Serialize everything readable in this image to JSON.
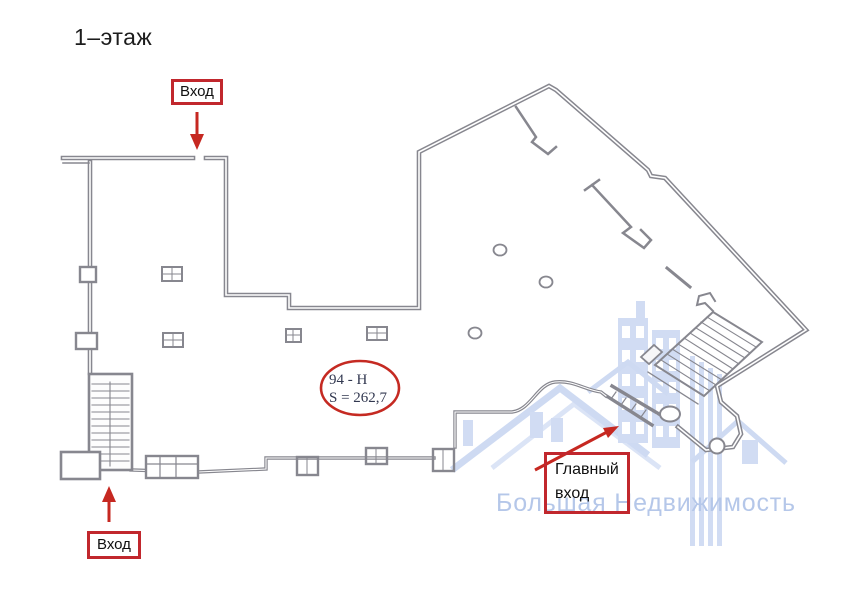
{
  "title": "1–этаж",
  "annotations": {
    "entrance_top": {
      "label": "Вход"
    },
    "entrance_bottom": {
      "label": "Вход"
    },
    "main_entrance": {
      "label": "Главный\nвход"
    }
  },
  "room": {
    "number": "94 - Н",
    "area": "S = 262,7"
  },
  "watermark": {
    "text": "Большая Недвижимость"
  },
  "colors": {
    "annotation_red": "#c1272d",
    "plan_gray": "#87878f",
    "watermark_blue": "#c6d4f0",
    "watermark_text_blue": "#abc0e7"
  },
  "icons": {
    "entrance_top_arrow": "arrow-down-icon",
    "entrance_bottom_arrow": "arrow-up-icon",
    "main_entrance_arrow": "arrow-up-right-icon"
  }
}
